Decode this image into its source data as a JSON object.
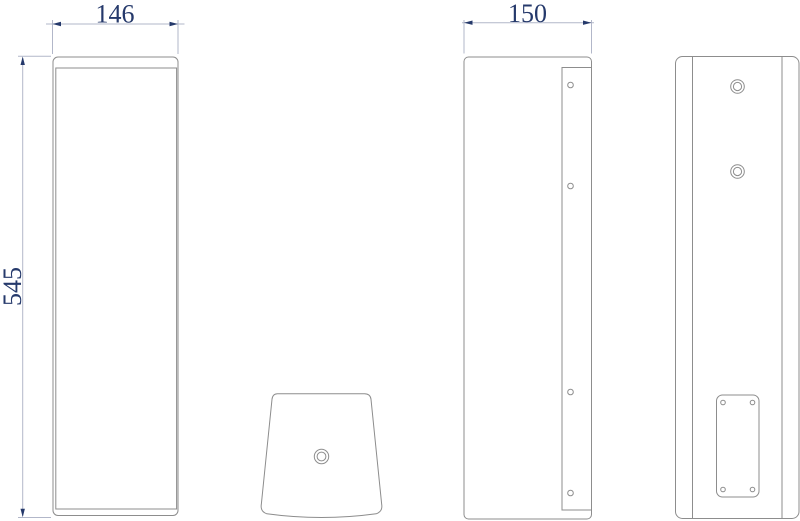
{
  "drawing": {
    "kind": "technical-drawing-three-views",
    "dimension_labels": {
      "width": "146",
      "height": "545",
      "depth": "150"
    },
    "colors": {
      "background": "#ffffff",
      "object_line": "#8d8d8d",
      "dimension_line": "#b2b7c9",
      "dimension_accent": "#25396b"
    }
  }
}
